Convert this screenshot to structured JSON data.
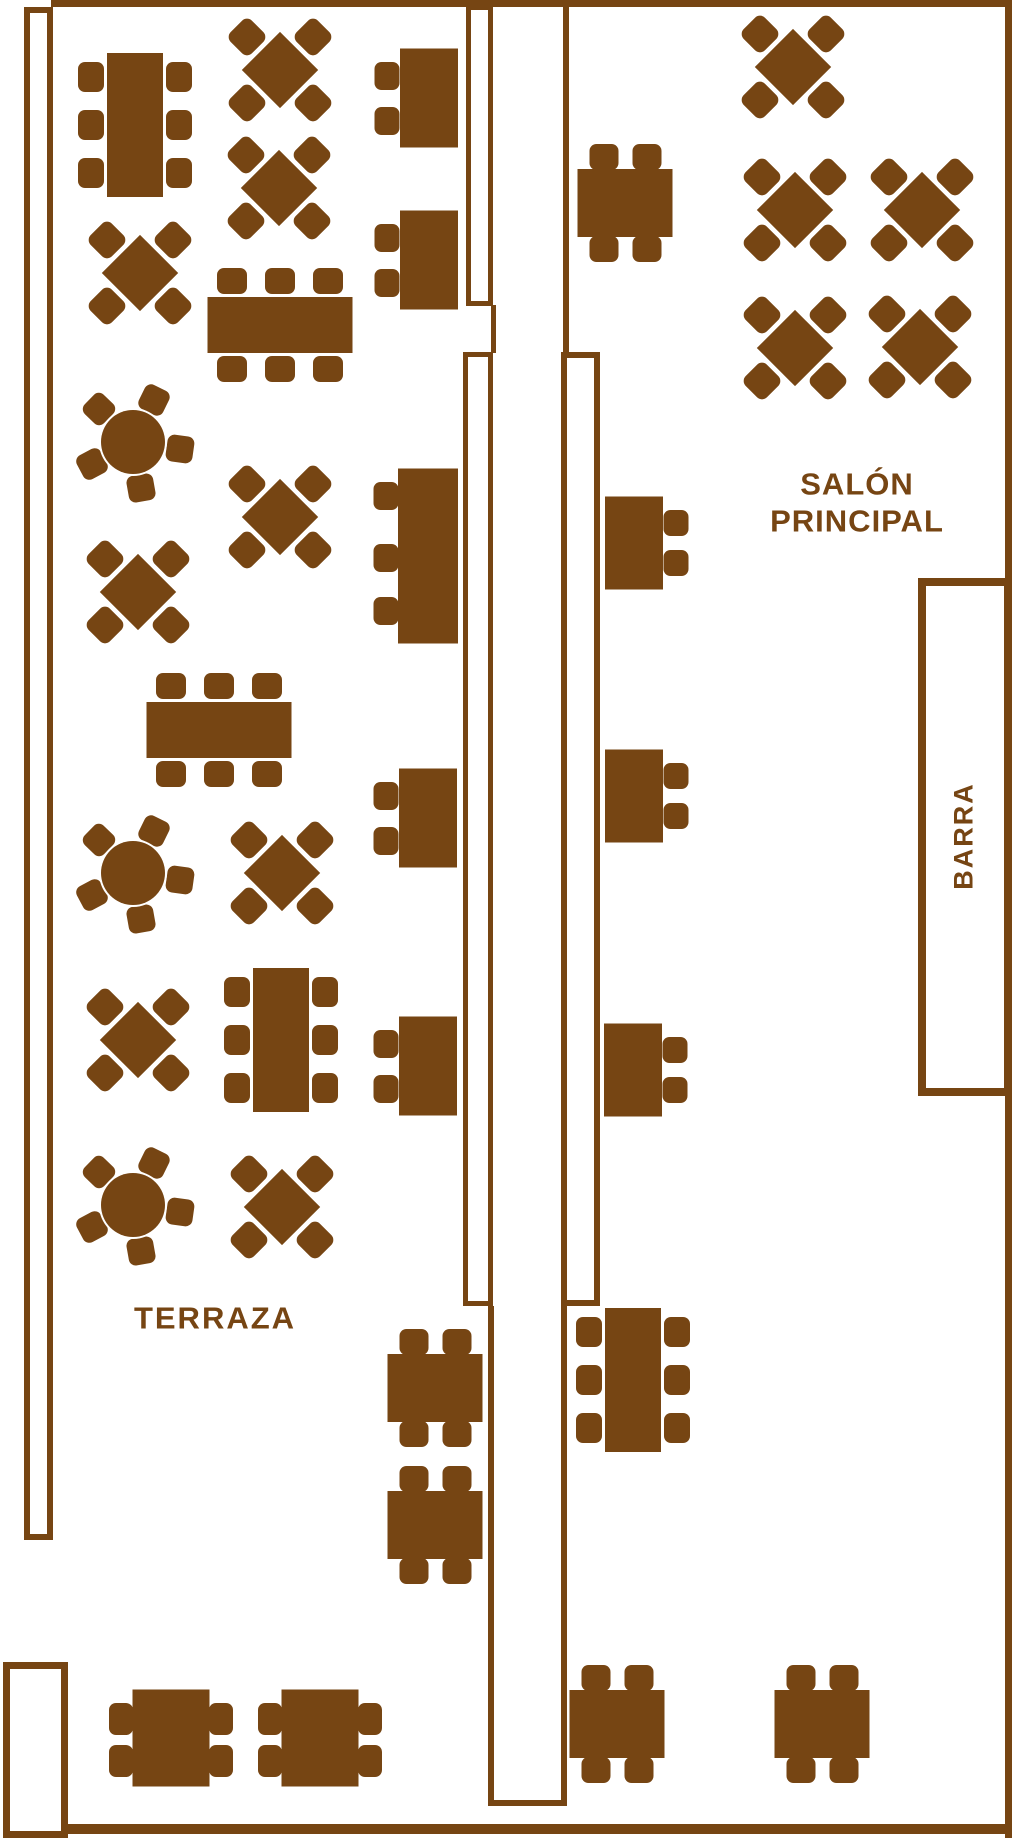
{
  "plan_title": "Restaurante - plano de mesas",
  "colors": {
    "wood": "#764513",
    "background": "#ffffff"
  },
  "labels": [
    {
      "id": "terraza",
      "text": "TERRAZA",
      "cx": 215,
      "cy": 1318,
      "font_size": 31,
      "letter_spacing": 2,
      "rotation": 0
    },
    {
      "id": "salon-1",
      "text": "SALÓN",
      "cx": 857,
      "cy": 484,
      "font_size": 31,
      "letter_spacing": 1,
      "rotation": 0
    },
    {
      "id": "salon-2",
      "text": "PRINCIPAL",
      "cx": 857,
      "cy": 521,
      "font_size": 31,
      "letter_spacing": 1,
      "rotation": 0
    },
    {
      "id": "barra",
      "text": "BARRA",
      "cx": 964,
      "cy": 836,
      "font_size": 27,
      "letter_spacing": 2,
      "rotation": -90
    }
  ],
  "walls": [
    {
      "name": "top-wall",
      "kind": "fill",
      "x": 51,
      "y": 0,
      "w": 961,
      "h": 7
    },
    {
      "name": "right-wall",
      "kind": "fill",
      "x": 1005,
      "y": 0,
      "w": 7,
      "h": 1838
    },
    {
      "name": "bottom-wall",
      "kind": "fill",
      "x": 62,
      "y": 1824,
      "w": 950,
      "h": 10
    },
    {
      "name": "left-wall",
      "kind": "room",
      "x": 24,
      "y": 7,
      "w": 29,
      "h": 1533,
      "stroke": 6
    },
    {
      "name": "entrance-vestibule",
      "kind": "room",
      "x": 3,
      "y": 1662,
      "w": 65,
      "h": 176,
      "stroke": 7
    },
    {
      "name": "aisle-top-left",
      "kind": "room",
      "x": 466,
      "y": 5,
      "w": 27,
      "h": 301,
      "stroke": 5
    },
    {
      "name": "aisle-top-right-line",
      "kind": "fill",
      "x": 563,
      "y": 0,
      "w": 6,
      "h": 352
    },
    {
      "name": "aisle-left-connector",
      "kind": "fill",
      "x": 491,
      "y": 305,
      "w": 5,
      "h": 48
    },
    {
      "name": "aisle-mid-left",
      "kind": "room",
      "x": 463,
      "y": 352,
      "w": 30,
      "h": 954,
      "stroke": 5
    },
    {
      "name": "aisle-mid-right",
      "kind": "room",
      "x": 561,
      "y": 352,
      "w": 39,
      "h": 954,
      "stroke": 6
    },
    {
      "name": "aisle-low-left-line",
      "kind": "fill",
      "x": 488,
      "y": 1306,
      "w": 6,
      "h": 500
    },
    {
      "name": "aisle-low-right-line",
      "kind": "fill",
      "x": 561,
      "y": 1306,
      "w": 6,
      "h": 500
    },
    {
      "name": "aisle-bottom-cap",
      "kind": "fill",
      "x": 488,
      "y": 1800,
      "w": 79,
      "h": 6
    },
    {
      "name": "bar-counter",
      "kind": "room",
      "x": 918,
      "y": 578,
      "w": 94,
      "h": 518,
      "stroke": 8
    }
  ],
  "table_types": {
    "rect6v": {
      "seats": 6,
      "body": {
        "w": 56,
        "h": 144
      },
      "chairs": [
        [
          -44,
          -48,
          26,
          30
        ],
        [
          -44,
          0,
          26,
          30
        ],
        [
          -44,
          48,
          26,
          30
        ],
        [
          44,
          -48,
          26,
          30
        ],
        [
          44,
          0,
          26,
          30
        ],
        [
          44,
          48,
          26,
          30
        ]
      ]
    },
    "rect6h": {
      "seats": 6,
      "body": {
        "w": 145,
        "h": 56
      },
      "chairs": [
        [
          -48,
          -44,
          30,
          26
        ],
        [
          0,
          -44,
          30,
          26
        ],
        [
          48,
          -44,
          30,
          26
        ],
        [
          -48,
          44,
          30,
          26
        ],
        [
          0,
          44,
          30,
          26
        ],
        [
          48,
          44,
          30,
          26
        ]
      ]
    },
    "xtable": {
      "seats": 4,
      "body": {
        "w": 54,
        "h": 54,
        "rot": 45
      },
      "chairs": [
        [
          -33,
          -33,
          30,
          30,
          45
        ],
        [
          33,
          -33,
          30,
          30,
          45
        ],
        [
          -33,
          33,
          30,
          30,
          45
        ],
        [
          33,
          33,
          30,
          30,
          45
        ]
      ]
    },
    "round5": {
      "seats": 5,
      "body": {
        "r": 32
      },
      "chairs": [
        [
          21,
          -42,
          27,
          27,
          26
        ],
        [
          47,
          7,
          27,
          27,
          98
        ],
        [
          8,
          46,
          27,
          27,
          -10
        ],
        [
          -41,
          22,
          27,
          27,
          62
        ],
        [
          -34,
          -33,
          27,
          27,
          -46
        ]
      ]
    },
    "sq4v": {
      "seats": 4,
      "body": {
        "w": 95,
        "h": 68
      },
      "chairs": [
        [
          -21,
          -46,
          29,
          26
        ],
        [
          22,
          -46,
          29,
          26
        ],
        [
          -21,
          46,
          29,
          26
        ],
        [
          22,
          46,
          29,
          26
        ]
      ]
    },
    "sq4h": {
      "seats": 4,
      "body": {
        "w": 77,
        "h": 97
      },
      "chairs": [
        [
          -50,
          -19,
          24,
          32
        ],
        [
          -50,
          23,
          24,
          32
        ],
        [
          50,
          -19,
          24,
          32
        ],
        [
          50,
          23,
          24,
          32
        ]
      ]
    },
    "side2L": {
      "seats": 2,
      "body": {
        "w": 58,
        "h": 99
      },
      "chairs": [
        [
          -42,
          -22,
          25,
          28
        ],
        [
          -42,
          23,
          25,
          28
        ]
      ]
    },
    "side3L": {
      "seats": 3,
      "body": {
        "w": 60,
        "h": 175
      },
      "chairs": [
        [
          -42,
          -60,
          25,
          28
        ],
        [
          -42,
          2,
          25,
          28
        ],
        [
          -42,
          55,
          25,
          28
        ]
      ]
    },
    "side2R": {
      "seats": 2,
      "body": {
        "w": 58,
        "h": 93
      },
      "chairs": [
        [
          42,
          -20,
          25,
          26
        ],
        [
          42,
          20,
          25,
          26
        ]
      ]
    }
  },
  "tables": [
    {
      "zone": "terraza",
      "type": "rect6v",
      "cx": 135,
      "cy": 125
    },
    {
      "zone": "terraza",
      "type": "xtable",
      "cx": 280,
      "cy": 70
    },
    {
      "zone": "terraza",
      "type": "xtable",
      "cx": 279,
      "cy": 188
    },
    {
      "zone": "terraza",
      "type": "xtable",
      "cx": 140,
      "cy": 273
    },
    {
      "zone": "terraza",
      "type": "rect6h",
      "cx": 280,
      "cy": 325
    },
    {
      "zone": "terraza",
      "type": "round5",
      "cx": 133,
      "cy": 442
    },
    {
      "zone": "terraza",
      "type": "xtable",
      "cx": 280,
      "cy": 517
    },
    {
      "zone": "terraza",
      "type": "xtable",
      "cx": 138,
      "cy": 592
    },
    {
      "zone": "terraza",
      "type": "rect6h",
      "cx": 219,
      "cy": 730
    },
    {
      "zone": "terraza",
      "type": "round5",
      "cx": 133,
      "cy": 873
    },
    {
      "zone": "terraza",
      "type": "xtable",
      "cx": 282,
      "cy": 873
    },
    {
      "zone": "terraza",
      "type": "xtable",
      "cx": 138,
      "cy": 1040
    },
    {
      "zone": "terraza",
      "type": "rect6v",
      "cx": 281,
      "cy": 1040
    },
    {
      "zone": "terraza",
      "type": "round5",
      "cx": 133,
      "cy": 1205
    },
    {
      "zone": "terraza",
      "type": "xtable",
      "cx": 282,
      "cy": 1207
    },
    {
      "zone": "aisle-left",
      "type": "side2L",
      "cx": 429,
      "cy": 98
    },
    {
      "zone": "aisle-left",
      "type": "side2L",
      "cx": 429,
      "cy": 260
    },
    {
      "zone": "aisle-left",
      "type": "side3L",
      "cx": 428,
      "cy": 556
    },
    {
      "zone": "aisle-left",
      "type": "side2L",
      "cx": 428,
      "cy": 818
    },
    {
      "zone": "aisle-left",
      "type": "side2L",
      "cx": 428,
      "cy": 1066
    },
    {
      "zone": "salon",
      "type": "sq4v",
      "cx": 625,
      "cy": 203
    },
    {
      "zone": "salon",
      "type": "xtable",
      "cx": 793,
      "cy": 67
    },
    {
      "zone": "salon",
      "type": "xtable",
      "cx": 795,
      "cy": 210
    },
    {
      "zone": "salon",
      "type": "xtable",
      "cx": 922,
      "cy": 210
    },
    {
      "zone": "salon",
      "type": "xtable",
      "cx": 795,
      "cy": 348
    },
    {
      "zone": "salon",
      "type": "xtable",
      "cx": 920,
      "cy": 347
    },
    {
      "zone": "aisle-right",
      "type": "side2R",
      "cx": 634,
      "cy": 543
    },
    {
      "zone": "aisle-right",
      "type": "side2R",
      "cx": 634,
      "cy": 796
    },
    {
      "zone": "aisle-right",
      "type": "side2R",
      "cx": 633,
      "cy": 1070
    },
    {
      "zone": "bottom",
      "type": "sq4v",
      "cx": 435,
      "cy": 1388
    },
    {
      "zone": "bottom",
      "type": "sq4v",
      "cx": 435,
      "cy": 1525
    },
    {
      "zone": "bottom",
      "type": "rect6v",
      "cx": 633,
      "cy": 1380
    },
    {
      "zone": "bottom",
      "type": "sq4h",
      "cx": 171,
      "cy": 1738
    },
    {
      "zone": "bottom",
      "type": "sq4h",
      "cx": 320,
      "cy": 1738
    },
    {
      "zone": "bottom",
      "type": "sq4v",
      "cx": 617,
      "cy": 1724
    },
    {
      "zone": "bottom",
      "type": "sq4v",
      "cx": 822,
      "cy": 1724
    }
  ]
}
